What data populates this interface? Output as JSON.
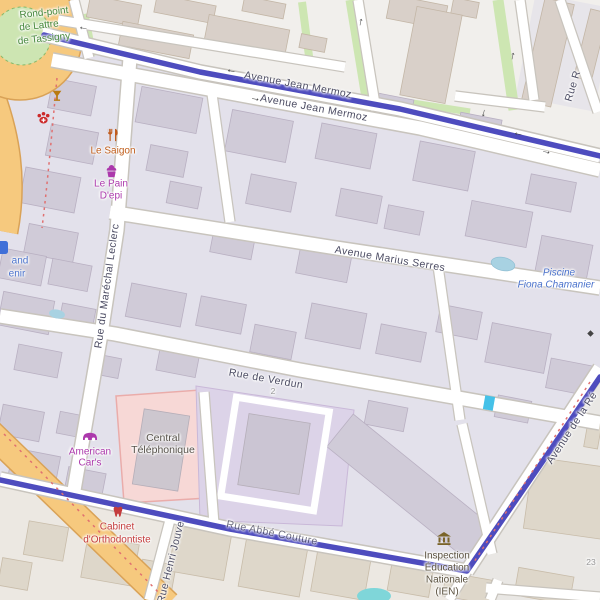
{
  "streets": {
    "mermoz_upper": "Avenue Jean Mermoz",
    "mermoz_lower": "Avenue Jean Mermoz",
    "marius_serres": "Avenue Marius Serres",
    "verdun": "Rue de Verdun",
    "abbe_couture": "Rue Abbé Couture",
    "marechal_leclerc": "Rue du Maréchal Leclerc",
    "henri_jouve": "Rue Henri Jouve",
    "republique": "Avenue de la Ré",
    "rue_r": "Rue R"
  },
  "labels": {
    "rondpoint": [
      "Rond-point",
      "de Lattre",
      "de Tassigny"
    ],
    "piscine": [
      "Piscine",
      "Fiona Chamanier"
    ],
    "saigon": "Le Saigon",
    "pain": [
      "Le Pain",
      "D'epi"
    ],
    "american": [
      "American",
      "Car's"
    ],
    "central": [
      "Central",
      "Téléphonique"
    ],
    "ortho": [
      "Cabinet",
      "d'Orthodontiste"
    ],
    "ien": [
      "Inspection",
      "Éducation",
      "Nationale",
      "(IEN)"
    ],
    "left_partial": [
      "and",
      "enir"
    ]
  },
  "housenumbers": {
    "verdun": "2",
    "republique": "23"
  },
  "arrows": {
    "left": "←",
    "right": "→",
    "up": "↑",
    "down": "↓"
  },
  "icons": [
    "bar-icon",
    "veterinary-icon",
    "restaurant-icon",
    "bakery-icon",
    "supermarket-icon",
    "car-dealer-icon",
    "dentist-icon",
    "government-icon",
    "marker-icon"
  ],
  "colors": {
    "route": "#4442ba",
    "primary_road": "#f6c97e",
    "water": "#a8d2e2",
    "pool_teal": "#7fd6d9",
    "grass": "#cde6b2",
    "pink_area": "#f7d8d6",
    "courtyard_area": "#dcd3e8",
    "building_north": "#d9d0c9",
    "building_inner": "#d0cbd8",
    "building_south": "#ded7ca"
  }
}
